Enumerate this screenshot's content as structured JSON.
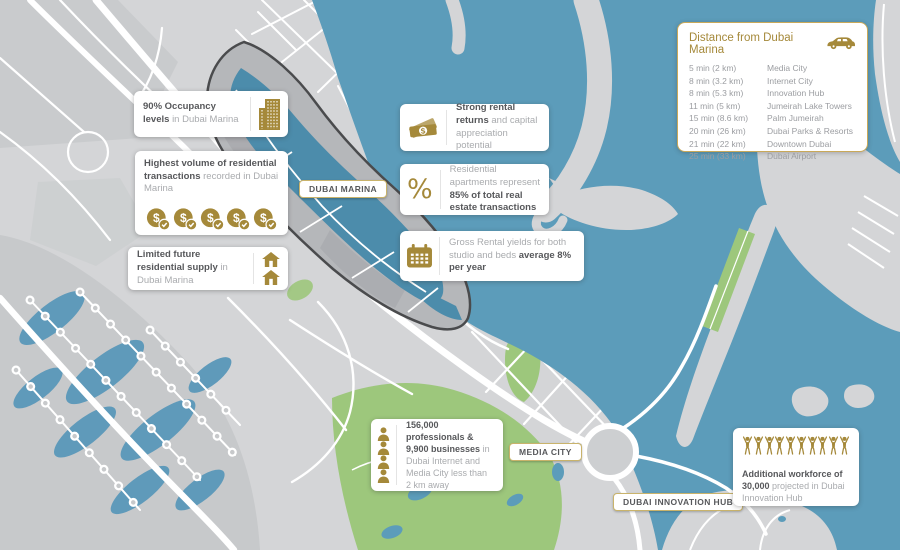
{
  "map": {
    "labels": {
      "marina": "DUBAI MARINA",
      "media_city": "MEDIA CITY",
      "innovation_hub": "DUBAI INNOVATION HUB"
    },
    "colors": {
      "sea": "#5C9CBA",
      "marina_water": "#4C8CAB",
      "land": "#D4D5D7",
      "park_green": "#9DC77C",
      "road": "#FFFFFF",
      "district_outline": "#4A4B4D",
      "gold_accent": "#A5893A",
      "text_dark": "#57585B",
      "text_gray": "#A9ABAE"
    }
  },
  "callouts": {
    "occupancy": {
      "bold": "90% Occupancy levels",
      "rest": "in Dubai Marina",
      "icon": "building-icon"
    },
    "transactions": {
      "bold": "Highest volume of residential transactions",
      "rest": "recorded in Dubai Marina",
      "icon": "dollar-coin-icon",
      "coin_count": 5
    },
    "supply": {
      "bold": "Limited future residential supply",
      "rest": "in Dubai Marina",
      "icon": "house-icon",
      "house_count": 2
    },
    "rental": {
      "bold": "Strong rental returns",
      "rest": "and capital appreciation potential",
      "icon": "banknotes-icon"
    },
    "apartments": {
      "lead": "Residential apartments represent",
      "bold": "85% of total real estate transactions",
      "icon": "percent-icon",
      "icon_text": "%"
    },
    "yields": {
      "lead": "Gross Rental yields for both studio and beds",
      "bold": "average 8% per year",
      "icon": "calendar-icon"
    },
    "professionals": {
      "bold": "156,000 professionals & 9,900 businesses",
      "rest": "in Dubai Internet and Media City less than 2 km away",
      "icon": "person-icon",
      "person_count": 4
    },
    "workforce": {
      "bold": "Additional workforce of 30,000",
      "rest": "projected in Dubai Innovation Hub",
      "icon": "cheering-person-icon",
      "figure_count": 10
    }
  },
  "distance_panel": {
    "title": "Distance from Dubai Marina",
    "icon": "car-icon",
    "rows": [
      {
        "time": "5 min (2 km)",
        "place": "Media City"
      },
      {
        "time": "8 min (3.2 km)",
        "place": "Internet City"
      },
      {
        "time": "8 min (5.3 km)",
        "place": "Innovation Hub"
      },
      {
        "time": "11 min (5 km)",
        "place": "Jumeirah Lake Towers"
      },
      {
        "time": "15 min (8.6 km)",
        "place": "Palm Jumeirah"
      },
      {
        "time": "20 min (26 km)",
        "place": "Dubai Parks & Resorts"
      },
      {
        "time": "21 min (22 km)",
        "place": "Downtown Dubai"
      },
      {
        "time": "25 min (33 km)",
        "place": "Dubai Airport"
      }
    ]
  }
}
